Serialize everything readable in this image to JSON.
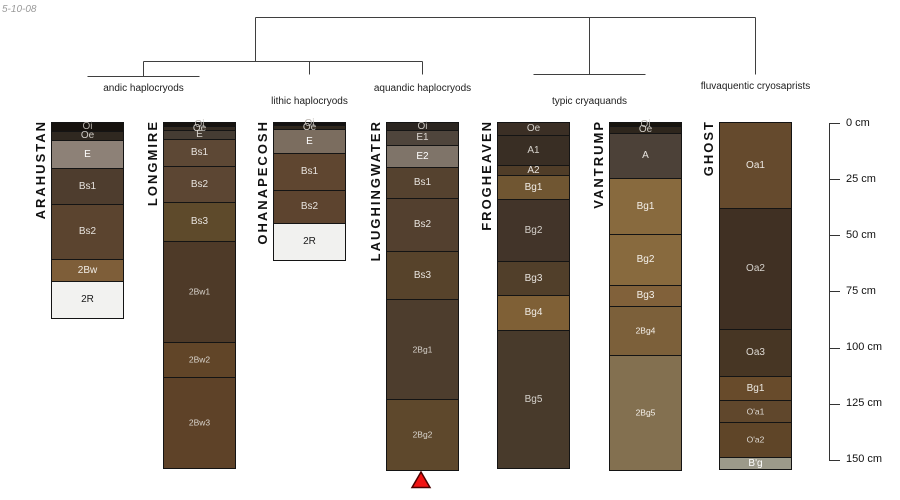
{
  "figure": {
    "date_label": "5-10-08"
  },
  "dendrogram": {
    "groups": [
      {
        "label": "andic haplocryods",
        "profiles": [
          "ARAHUSTAN",
          "LONGMIRE"
        ]
      },
      {
        "label": "lithic haplocryods",
        "profiles": [
          "OHANAPECOSH"
        ]
      },
      {
        "label": "aquandic haplocryods",
        "profiles": [
          "LAUGHINGWATER"
        ]
      },
      {
        "label": "typic cryaquands",
        "profiles": [
          "FROGHEAVEN",
          "VANTRUMP"
        ]
      },
      {
        "label": "fluvaquentic cryosaprists",
        "profiles": [
          "GHOST"
        ]
      }
    ]
  },
  "depth_axis": {
    "unit": "cm",
    "tick_labels": [
      "0 cm",
      "25 cm",
      "50 cm",
      "75 cm",
      "100 cm",
      "125 cm",
      "150 cm"
    ],
    "tick_values": [
      0,
      25,
      50,
      75,
      100,
      125,
      150
    ]
  },
  "marker": {
    "shape": "triangle-up",
    "color": "#f21313",
    "border_color": "#4d0000",
    "below_profile": "LAUGHINGWATER"
  },
  "chart_data": {
    "type": "stratigraphic-columns",
    "title": "",
    "ylabel": "depth (cm)",
    "ylim": [
      0,
      150
    ],
    "profiles": [
      {
        "name": "ARAHUSTAN",
        "group": "andic haplocryods",
        "horizons": [
          {
            "label": "Oi",
            "top_cm": 0,
            "bottom_cm": 4,
            "color": "#16120e",
            "text": "#b3aea8"
          },
          {
            "label": "Oe",
            "top_cm": 4,
            "bottom_cm": 8,
            "color": "#2f2820",
            "text": "#cfcbc5"
          },
          {
            "label": "E",
            "top_cm": 8,
            "bottom_cm": 20.5,
            "color": "#8d8177",
            "text": "#ffffff"
          },
          {
            "label": "Bs1",
            "top_cm": 20.5,
            "bottom_cm": 36.5,
            "color": "#4e3d2e",
            "text": "#e7e3de"
          },
          {
            "label": "Bs2",
            "top_cm": 36.5,
            "bottom_cm": 61,
            "color": "#5b442f",
            "text": "#e7e3de"
          },
          {
            "label": "2Bw",
            "top_cm": 61,
            "bottom_cm": 71,
            "color": "#7e5e39",
            "text": "#f0ece6"
          },
          {
            "label": "2R",
            "top_cm": 71,
            "bottom_cm": 87,
            "color": "#f2f2f0",
            "text": "#1a1a1a"
          }
        ]
      },
      {
        "name": "LONGMIRE",
        "group": "andic haplocryods",
        "horizons": [
          {
            "label": "Oi",
            "top_cm": 0,
            "bottom_cm": 2,
            "color": "#17130f",
            "text": "#b3aea8"
          },
          {
            "label": "Oe",
            "top_cm": 2,
            "bottom_cm": 4,
            "color": "#332a21",
            "text": "#cfcbc5"
          },
          {
            "label": "E",
            "top_cm": 4,
            "bottom_cm": 8,
            "color": "#453c33",
            "text": "#d8d4ce"
          },
          {
            "label": "Bs1",
            "top_cm": 8,
            "bottom_cm": 20,
            "color": "#5d4835",
            "text": "#e7e3de"
          },
          {
            "label": "Bs2",
            "top_cm": 20,
            "bottom_cm": 36,
            "color": "#5c4633",
            "text": "#e7e3de"
          },
          {
            "label": "Bs3",
            "top_cm": 36,
            "bottom_cm": 53.5,
            "color": "#5e4a2b",
            "text": "#e7e3de"
          },
          {
            "label": "2Bw1",
            "top_cm": 53.5,
            "bottom_cm": 98.5,
            "color": "#4e3a28",
            "text": "#d9d4cd",
            "small": true
          },
          {
            "label": "2Bw2",
            "top_cm": 98.5,
            "bottom_cm": 114,
            "color": "#614528",
            "text": "#d9d4cd",
            "small": true
          },
          {
            "label": "2Bw3",
            "top_cm": 114,
            "bottom_cm": 154,
            "color": "#5e4228",
            "text": "#d9d4cd",
            "small": true
          }
        ]
      },
      {
        "name": "OHANAPECOSH",
        "group": "lithic haplocryods",
        "horizons": [
          {
            "label": "Oi",
            "top_cm": 0,
            "bottom_cm": 1.5,
            "color": "#141110",
            "text": "#b3aea8"
          },
          {
            "label": "Oe",
            "top_cm": 1.5,
            "bottom_cm": 3.5,
            "color": "#2f271d",
            "text": "#cfcbc5"
          },
          {
            "label": "E",
            "top_cm": 3.5,
            "bottom_cm": 14,
            "color": "#7b6d5f",
            "text": "#ffffff"
          },
          {
            "label": "Bs1",
            "top_cm": 14,
            "bottom_cm": 30.5,
            "color": "#5f4630",
            "text": "#e7e3de"
          },
          {
            "label": "Bs2",
            "top_cm": 30.5,
            "bottom_cm": 45,
            "color": "#5d442f",
            "text": "#e7e3de"
          },
          {
            "label": "2R",
            "top_cm": 45,
            "bottom_cm": 61,
            "color": "#f1f1ef",
            "text": "#1a1a1a"
          }
        ]
      },
      {
        "name": "LAUGHINGWATER",
        "group": "aquandic haplocryods",
        "horizons": [
          {
            "label": "Oi",
            "top_cm": 0,
            "bottom_cm": 3.5,
            "color": "#2b2520",
            "text": "#c8c3bd"
          },
          {
            "label": "E1",
            "top_cm": 3.5,
            "bottom_cm": 10,
            "color": "#4f453c",
            "text": "#ddd9d3"
          },
          {
            "label": "E2",
            "top_cm": 10,
            "bottom_cm": 20,
            "color": "#7f7469",
            "text": "#ffffff"
          },
          {
            "label": "Bs1",
            "top_cm": 20,
            "bottom_cm": 34,
            "color": "#55422f",
            "text": "#e7e3de"
          },
          {
            "label": "Bs2",
            "top_cm": 34,
            "bottom_cm": 57.5,
            "color": "#53402f",
            "text": "#e7e3de"
          },
          {
            "label": "Bs3",
            "top_cm": 57.5,
            "bottom_cm": 79,
            "color": "#57432b",
            "text": "#e7e3de"
          },
          {
            "label": "2Bg1",
            "top_cm": 79,
            "bottom_cm": 123.5,
            "color": "#4d3d2d",
            "text": "#d5d0c9",
            "small": true
          },
          {
            "label": "2Bg2",
            "top_cm": 123.5,
            "bottom_cm": 154.5,
            "color": "#5e482c",
            "text": "#d9d4cd",
            "small": true
          }
        ]
      },
      {
        "name": "FROGHEAVEN",
        "group": "typic cryaquands",
        "horizons": [
          {
            "label": "Oe",
            "top_cm": 0,
            "bottom_cm": 6,
            "color": "#3b2f25",
            "text": "#d5d1cb"
          },
          {
            "label": "A1",
            "top_cm": 6,
            "bottom_cm": 19.5,
            "color": "#392e24",
            "text": "#d5d1cb"
          },
          {
            "label": "A2",
            "top_cm": 19.5,
            "bottom_cm": 24,
            "color": "#503d28",
            "text": "#e7e3de"
          },
          {
            "label": "Bg1",
            "top_cm": 24,
            "bottom_cm": 34.5,
            "color": "#705632",
            "text": "#f0ece6"
          },
          {
            "label": "Bg2",
            "top_cm": 34.5,
            "bottom_cm": 62,
            "color": "#423429",
            "text": "#d5d1cb"
          },
          {
            "label": "Bg3",
            "top_cm": 62,
            "bottom_cm": 77,
            "color": "#513f2a",
            "text": "#e7e3de"
          },
          {
            "label": "Bg4",
            "top_cm": 77,
            "bottom_cm": 92.5,
            "color": "#7f6036",
            "text": "#f0ece6"
          },
          {
            "label": "Bg5",
            "top_cm": 92.5,
            "bottom_cm": 153.5,
            "color": "#483a2b",
            "text": "#d5d1cb"
          }
        ]
      },
      {
        "name": "VANTRUMP",
        "group": "typic cryaquands",
        "horizons": [
          {
            "label": "Oi",
            "top_cm": 0,
            "bottom_cm": 2,
            "color": "#18140e",
            "text": "#b3aea8"
          },
          {
            "label": "Oe",
            "top_cm": 2,
            "bottom_cm": 5,
            "color": "#2e261d",
            "text": "#cfcbc5"
          },
          {
            "label": "A",
            "top_cm": 5,
            "bottom_cm": 25,
            "color": "#4c4138",
            "text": "#e7e3de"
          },
          {
            "label": "Bg1",
            "top_cm": 25,
            "bottom_cm": 50,
            "color": "#886a3e",
            "text": "#f4f0ea"
          },
          {
            "label": "Bg2",
            "top_cm": 50,
            "bottom_cm": 72.5,
            "color": "#886a3e",
            "text": "#f4f0ea"
          },
          {
            "label": "Bg3",
            "top_cm": 72.5,
            "bottom_cm": 82,
            "color": "#81613a",
            "text": "#f4f0ea"
          },
          {
            "label": "2Bg4",
            "top_cm": 82,
            "bottom_cm": 104,
            "color": "#7c603a",
            "text": "#f4f0ea",
            "small": true
          },
          {
            "label": "2Bg5",
            "top_cm": 104,
            "bottom_cm": 155,
            "color": "#837050",
            "text": "#f4f0ea",
            "small": true
          }
        ]
      },
      {
        "name": "GHOST",
        "group": "fluvaquentic cryosaprists",
        "horizons": [
          {
            "label": "Oa1",
            "top_cm": 0,
            "bottom_cm": 38.5,
            "color": "#654a2d",
            "text": "#ebe8e2"
          },
          {
            "label": "Oa2",
            "top_cm": 38.5,
            "bottom_cm": 92.5,
            "color": "#403023",
            "text": "#d5d1cb"
          },
          {
            "label": "Oa3",
            "top_cm": 92.5,
            "bottom_cm": 113.5,
            "color": "#473624",
            "text": "#ddd9d3"
          },
          {
            "label": "Bg1",
            "top_cm": 113.5,
            "bottom_cm": 124,
            "color": "#684b2b",
            "text": "#ebe8e2"
          },
          {
            "label": "O'a1",
            "top_cm": 124,
            "bottom_cm": 134,
            "color": "#60472c",
            "text": "#ddd9d3",
            "small": true
          },
          {
            "label": "O'a2",
            "top_cm": 134,
            "bottom_cm": 149.5,
            "color": "#5f4528",
            "text": "#ddd9d3",
            "small": true
          },
          {
            "label": "B'g",
            "top_cm": 149.5,
            "bottom_cm": 154.5,
            "color": "#9c9a8a",
            "text": "#ffffff"
          }
        ]
      }
    ]
  }
}
